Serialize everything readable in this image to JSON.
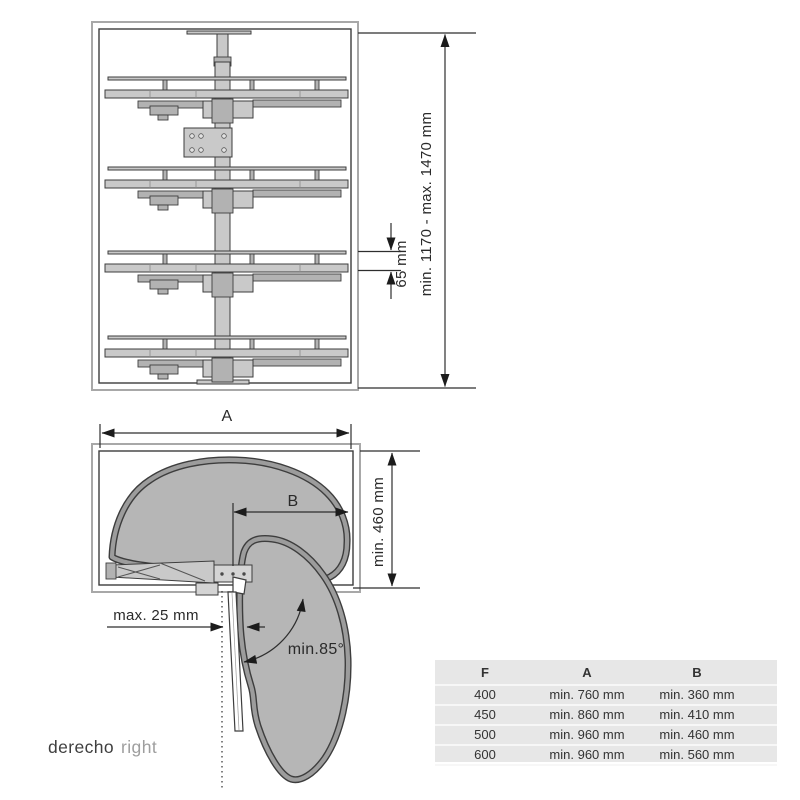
{
  "front_view": {
    "height_dim": "min. 1170 - max. 1470 mm",
    "shelf_edge_dim": "65 mm"
  },
  "plan_view": {
    "width_label": "A",
    "arm_label": "B",
    "depth_dim": "min. 460 mm",
    "door_gap_dim": "max. 25 mm",
    "opening_angle": "min.85°"
  },
  "caption": {
    "primary": "derecho",
    "secondary": "right"
  },
  "table": {
    "headers": [
      "F",
      "A",
      "B"
    ],
    "rows": [
      [
        "400",
        "min. 760 mm",
        "min. 360 mm"
      ],
      [
        "450",
        "min. 860 mm",
        "min. 410 mm"
      ],
      [
        "500",
        "min. 960 mm",
        "min. 460 mm"
      ],
      [
        "600",
        "min. 960 mm",
        "min. 560 mm"
      ]
    ]
  },
  "colors": {
    "line": "#3d3d3d",
    "box_outer": "#a8a8a8",
    "metal": "#c9c9c9",
    "metal_dark": "#b2b2b2",
    "shelf_fill": "#b6b6b6",
    "shelf_rim": "#9c9c9c",
    "table_bg": "#e7e7e7",
    "table_line": "#f7f7f7",
    "text_dark": "#3f3f3f",
    "text_light": "#9e9e9e"
  }
}
